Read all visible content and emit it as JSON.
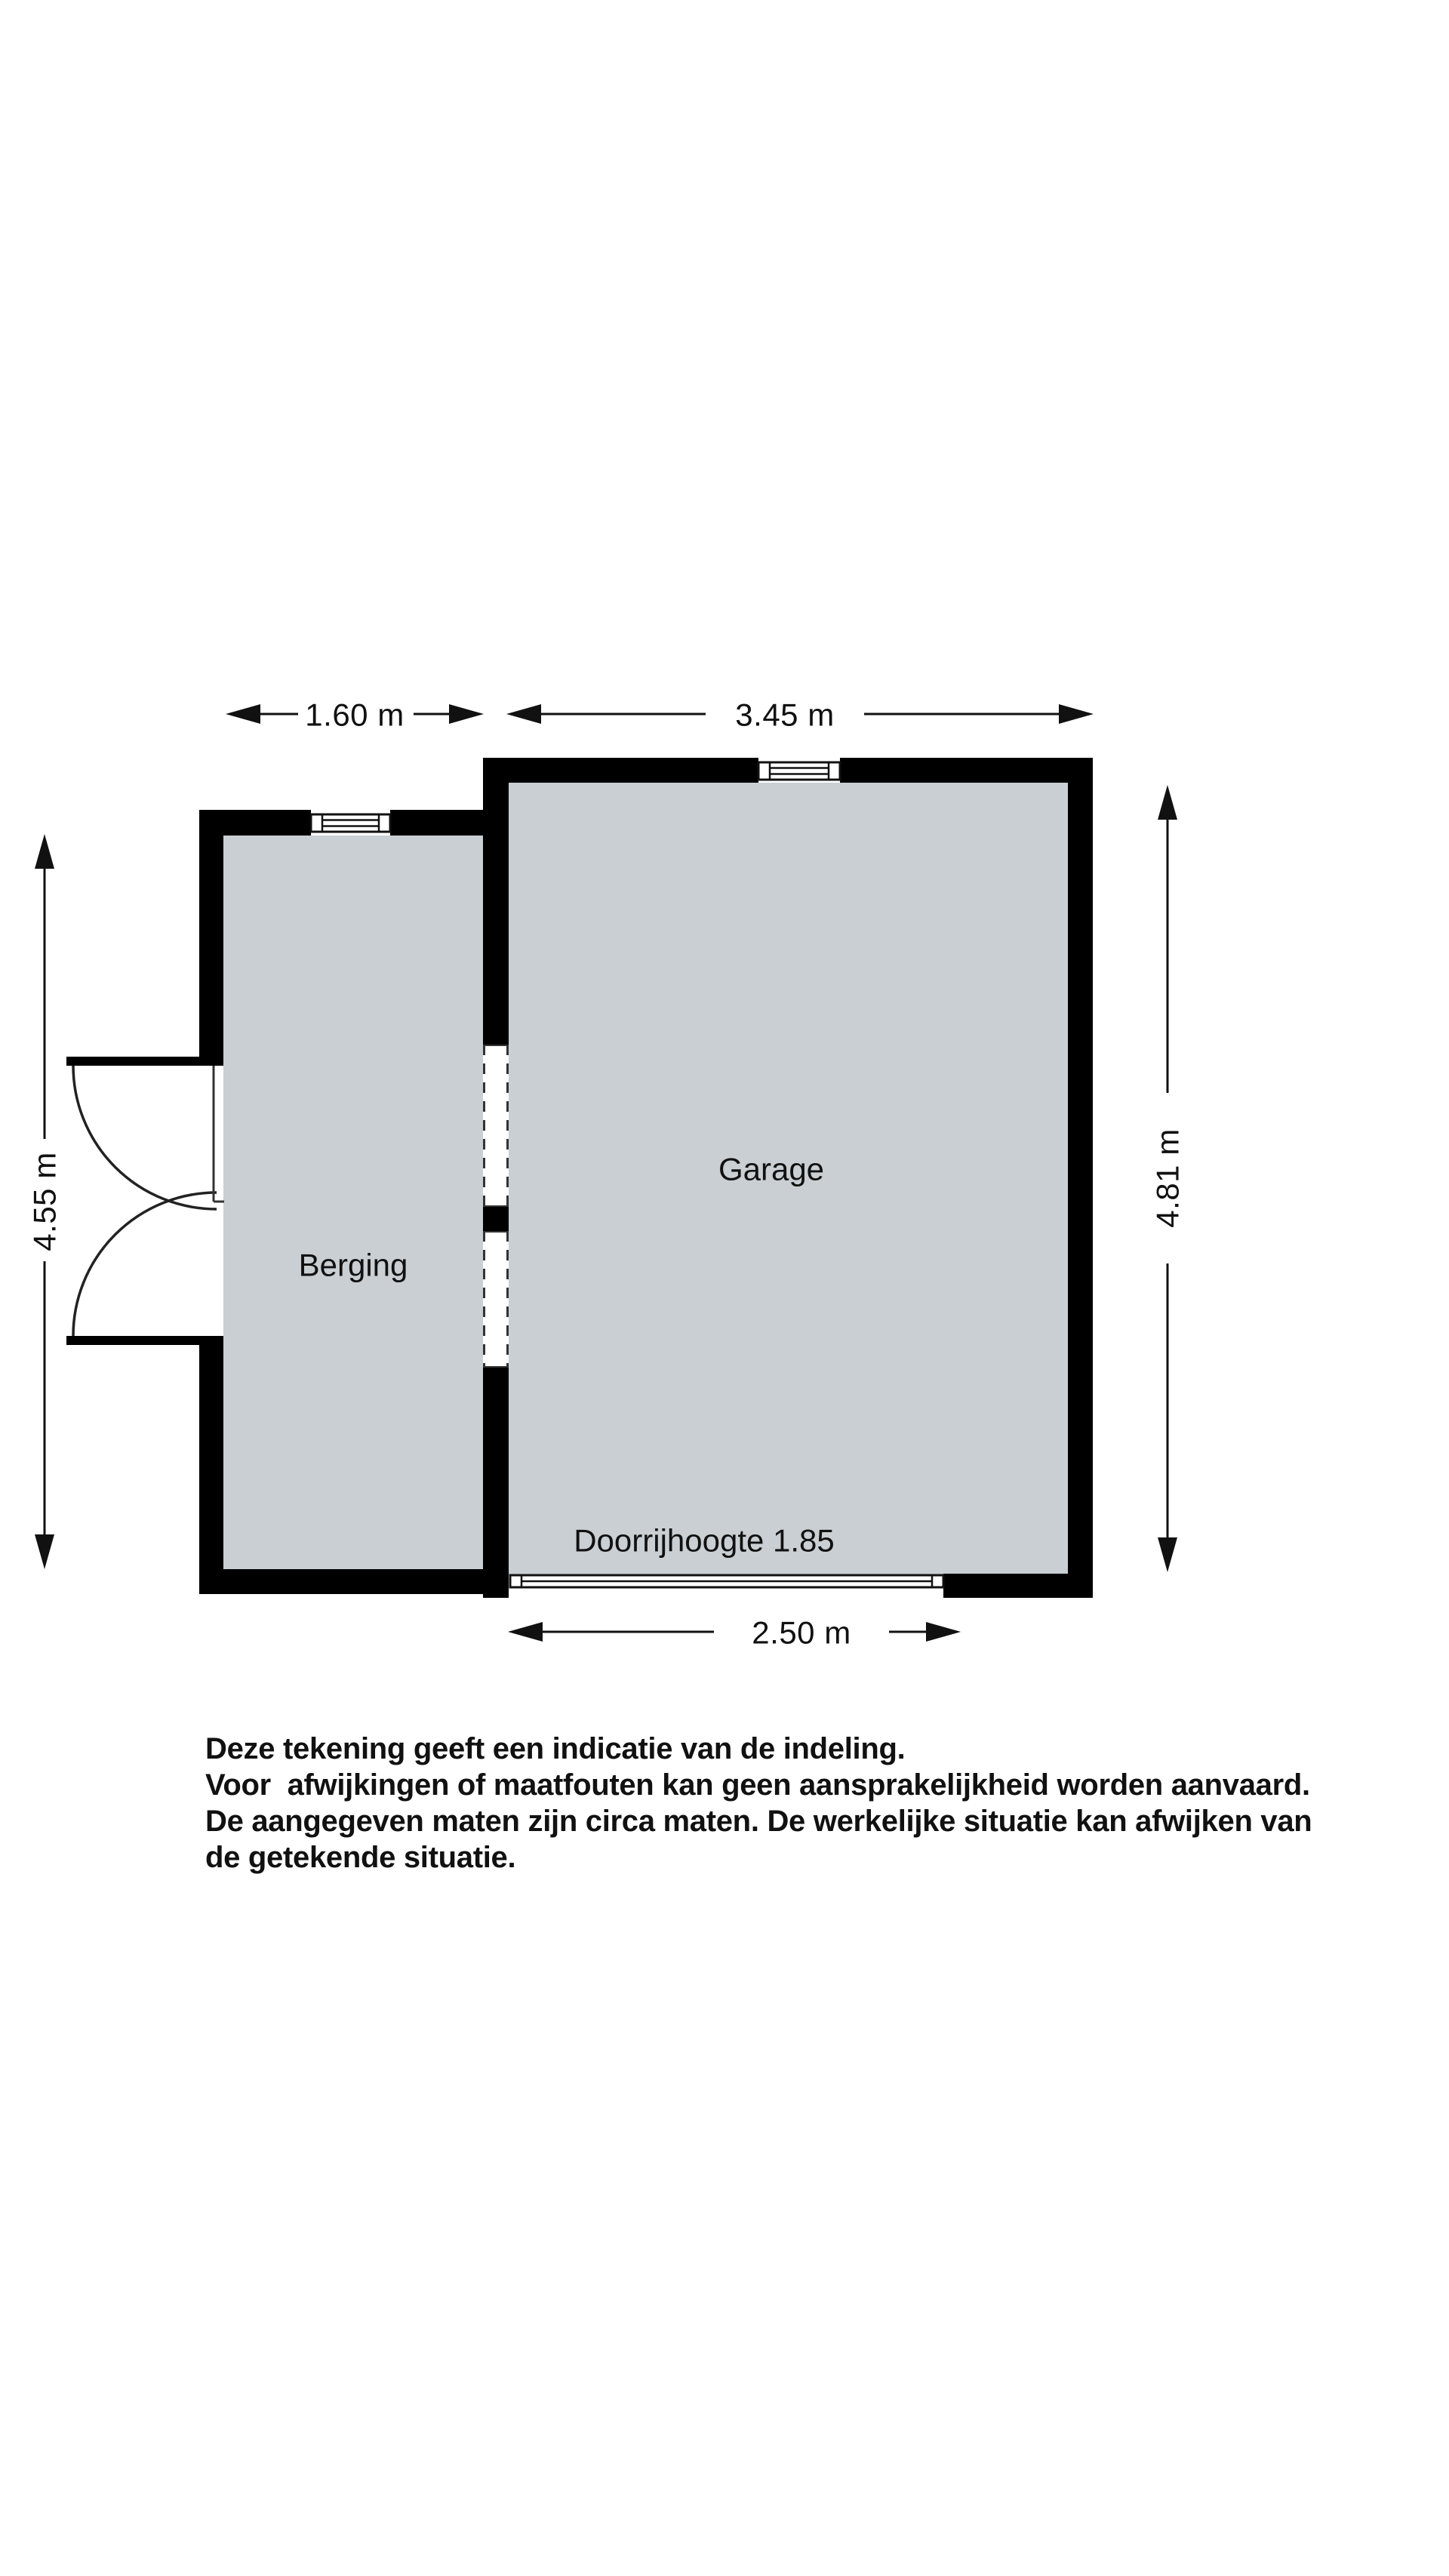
{
  "colors": {
    "background": "#ffffff",
    "wall": "#000000",
    "floor": "#c9cfd2",
    "line_and_text": "#111111",
    "dashed_opening": "#333333"
  },
  "floorplan": {
    "rooms": [
      {
        "label": "Berging"
      },
      {
        "label": "Garage"
      }
    ],
    "annotations": {
      "clearance_note": "Doorrijhoogte 1.85"
    },
    "dimensions": {
      "berging_width": "1.60 m",
      "garage_width": "3.45 m",
      "berging_depth": "4.55 m",
      "garage_depth": "4.81 m",
      "garage_door_width": "2.50 m"
    }
  },
  "disclaimer": {
    "lines": [
      "Deze tekening geeft een indicatie van de indeling.",
      "Voor  afwijkingen of maatfouten kan geen aansprakelijkheid worden aanvaard.",
      "De aangegeven maten zijn circa maten. De werkelijke situatie kan afwijken van",
      "de getekende situatie."
    ]
  }
}
